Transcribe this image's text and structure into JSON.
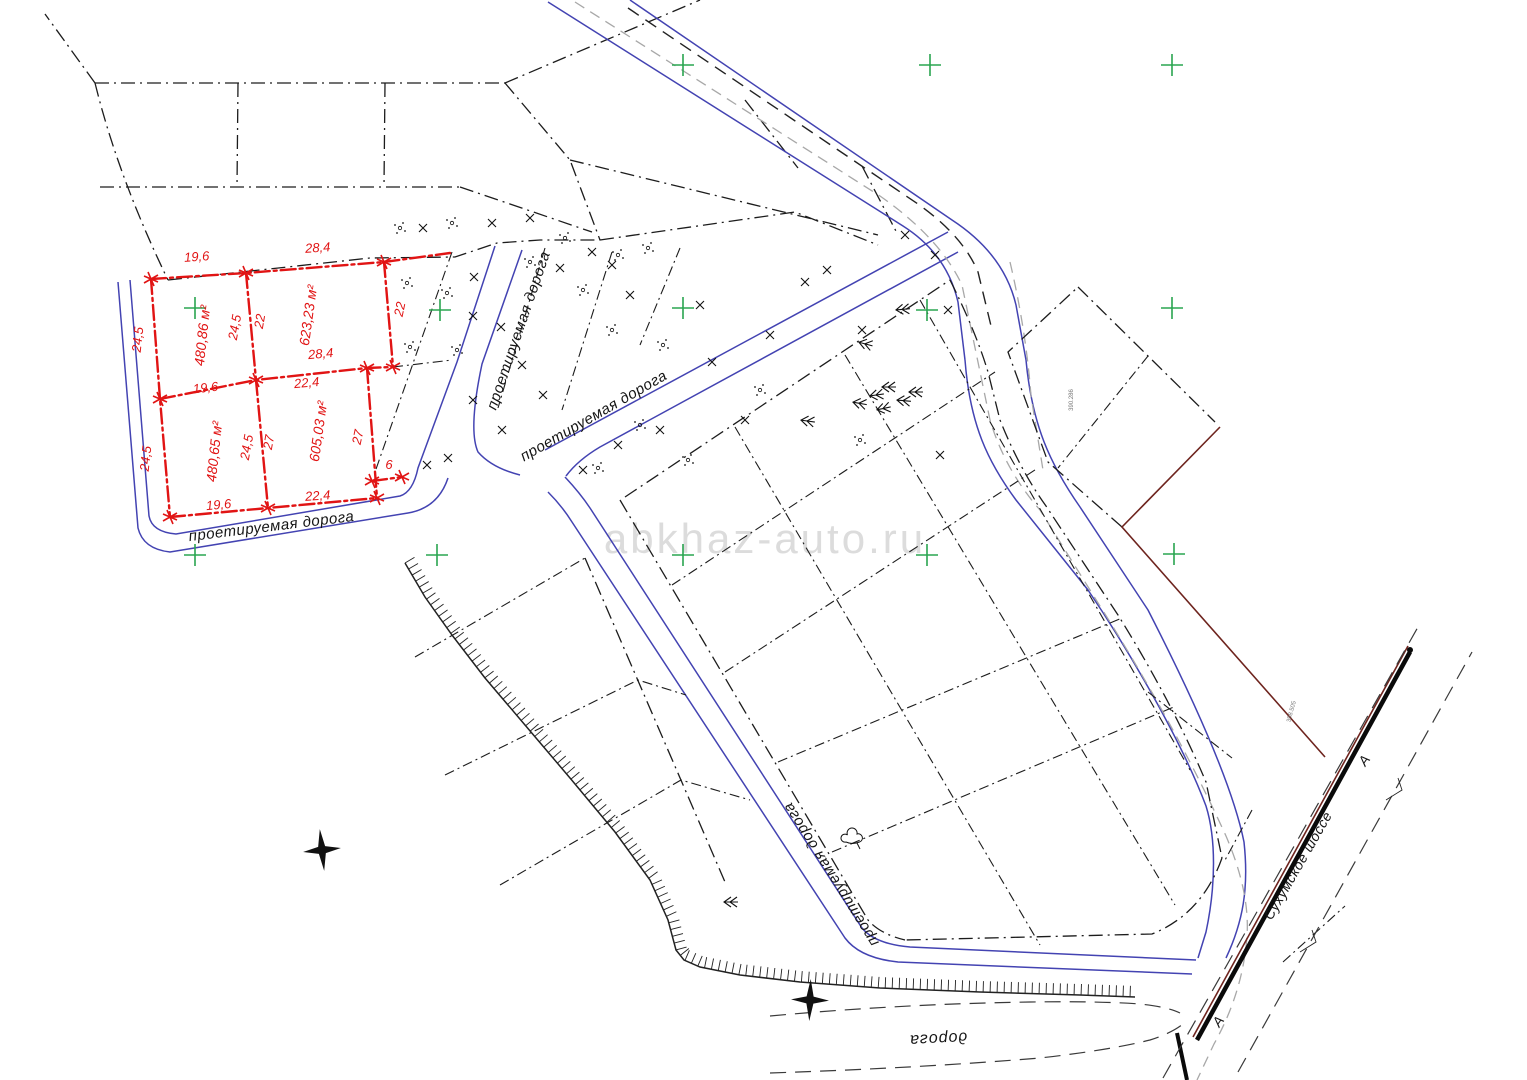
{
  "watermark": "abkhaz-auto.ru",
  "colors": {
    "plot_red": "#e11414",
    "road_blue": "#4343b2",
    "boundary_dark_red": "#6e241e",
    "grid_green": "#2aa550",
    "gray_dash": "#a8a8a8",
    "line_black": "#1c1c1c",
    "watermark_gray": "#dcdcdc"
  },
  "plots": [
    {
      "area_label": "480,86 м²",
      "sides": {
        "top": "19,6",
        "bottom": "19,6",
        "left": "24,5",
        "right": "24,5"
      }
    },
    {
      "area_label": "623,23 м²",
      "sides": {
        "top": "28,4",
        "bottom": "28,4",
        "left": "22",
        "right": "22"
      }
    },
    {
      "area_label": "480,65 м²",
      "sides": {
        "top": "19,6",
        "bottom": "19,6",
        "left": "24,5",
        "right": "24,5"
      }
    },
    {
      "area_label": "605,03 м²",
      "sides": {
        "top": "22,4",
        "bottom": "22,4",
        "left": "27",
        "right": "27"
      }
    }
  ],
  "extra_dimension": "6",
  "labels": {
    "items": [
      {
        "name": "dim-top-1",
        "text": "19,6",
        "x": 197,
        "y": 261,
        "rot": -4,
        "cls": "dim"
      },
      {
        "name": "dim-top-2",
        "text": "28,4",
        "x": 318,
        "y": 252,
        "rot": -4,
        "cls": "dim"
      },
      {
        "name": "dim-left-upper",
        "text": "24,5",
        "x": 142,
        "y": 340,
        "rot": -84,
        "cls": "dim"
      },
      {
        "name": "dim-mid-upper-w",
        "text": "24,5",
        "x": 239,
        "y": 328,
        "rot": -80,
        "cls": "dim"
      },
      {
        "name": "dim-mid-upper-e",
        "text": "22",
        "x": 264,
        "y": 322,
        "rot": -80,
        "cls": "dim"
      },
      {
        "name": "dim-right-upper",
        "text": "22",
        "x": 404,
        "y": 310,
        "rot": -78,
        "cls": "dim"
      },
      {
        "name": "dim-mid-1",
        "text": "19,6",
        "x": 206,
        "y": 392,
        "rot": -6,
        "cls": "dim"
      },
      {
        "name": "dim-mid-2",
        "text": "28,4",
        "x": 321,
        "y": 358,
        "rot": -5,
        "cls": "dim"
      },
      {
        "name": "dim-mid-3",
        "text": "22,4",
        "x": 307,
        "y": 387,
        "rot": -5,
        "cls": "dim"
      },
      {
        "name": "dim-left-lower",
        "text": "24,5",
        "x": 150,
        "y": 459,
        "rot": -84,
        "cls": "dim"
      },
      {
        "name": "dim-mid-lower-w",
        "text": "24,5",
        "x": 251,
        "y": 448,
        "rot": -80,
        "cls": "dim"
      },
      {
        "name": "dim-mid-lower-e",
        "text": "27",
        "x": 273,
        "y": 443,
        "rot": -80,
        "cls": "dim"
      },
      {
        "name": "dim-right-lower",
        "text": "27",
        "x": 362,
        "y": 438,
        "rot": -78,
        "cls": "dim"
      },
      {
        "name": "dim-ext",
        "text": "6",
        "x": 389,
        "y": 469,
        "rot": 0,
        "cls": "dim"
      },
      {
        "name": "dim-bot-1",
        "text": "19,6",
        "x": 219,
        "y": 509,
        "rot": -5,
        "cls": "dim"
      },
      {
        "name": "dim-bot-2",
        "text": "22,4",
        "x": 318,
        "y": 500,
        "rot": -4,
        "cls": "dim"
      },
      {
        "name": "area-plot-1",
        "text": "480,86 м²",
        "x": 207,
        "y": 336,
        "rot": -84,
        "cls": "area"
      },
      {
        "name": "area-plot-2",
        "text": "623,23 м²",
        "x": 313,
        "y": 316,
        "rot": -82,
        "cls": "area"
      },
      {
        "name": "area-plot-3",
        "text": "480,65 м²",
        "x": 219,
        "y": 452,
        "rot": -84,
        "cls": "area"
      },
      {
        "name": "area-plot-4",
        "text": "605,03 м²",
        "x": 323,
        "y": 432,
        "rot": -82,
        "cls": "area"
      },
      {
        "name": "road-label-southwest",
        "text": "проетируемая дорога",
        "x": 272,
        "y": 531,
        "rot": -7,
        "cls": "road-lbl"
      },
      {
        "name": "road-label-north",
        "text": "проетируемая дорога",
        "x": 523,
        "y": 332,
        "rot": -71,
        "cls": "road-lbl"
      },
      {
        "name": "road-label-diagonal",
        "text": "проетируемая дорога",
        "x": 596,
        "y": 420,
        "rot": -30,
        "cls": "road-lbl"
      },
      {
        "name": "road-label-central",
        "text": "проетируемая дорога",
        "x": 835,
        "y": 872,
        "rot": -122,
        "cls": "road-lbl"
      },
      {
        "name": "road-label-bottom",
        "text": "дорога",
        "x": 938,
        "y": 1034,
        "rot": 177,
        "cls": "road-lbl2"
      },
      {
        "name": "highway-label",
        "text": "Сухумское шоссе",
        "x": 1302,
        "y": 868,
        "rot": -60,
        "cls": "hw"
      },
      {
        "name": "axis-letter-1",
        "text": "А",
        "x": 1222,
        "y": 1024,
        "rot": -55,
        "cls": "a"
      },
      {
        "name": "axis-letter-2",
        "text": "А",
        "x": 1368,
        "y": 763,
        "rot": -55,
        "cls": "a"
      },
      {
        "name": "coord-note-1",
        "text": "390.286",
        "x": 1073,
        "y": 400,
        "rot": -90,
        "cls": "tiny"
      },
      {
        "name": "coord-note-2",
        "text": "398.505",
        "x": 1293,
        "y": 712,
        "rot": -75,
        "cls": "tiny"
      }
    ]
  },
  "symbols": {
    "green_crosses": [
      [
        683,
        65
      ],
      [
        930,
        65
      ],
      [
        1172,
        65
      ],
      [
        195,
        308
      ],
      [
        440,
        310
      ],
      [
        683,
        308
      ],
      [
        927,
        310
      ],
      [
        1172,
        308
      ],
      [
        195,
        555
      ],
      [
        437,
        555
      ],
      [
        683,
        555
      ],
      [
        927,
        555
      ],
      [
        1174,
        554
      ]
    ],
    "survey_stars": [
      [
        322,
        850,
        -6
      ],
      [
        810,
        1000,
        2
      ]
    ],
    "conifer_trees": [
      [
        895,
        310,
        -5
      ],
      [
        852,
        402,
        10
      ],
      [
        869,
        396,
        -8
      ],
      [
        881,
        387,
        0
      ],
      [
        896,
        400,
        5
      ],
      [
        876,
        410,
        -12
      ],
      [
        908,
        392,
        0
      ],
      [
        800,
        420,
        8
      ],
      [
        723,
        902,
        0
      ],
      [
        858,
        342,
        15
      ]
    ],
    "cloud_trees": [
      [
        852,
        840,
        0
      ]
    ],
    "x_marks": [
      [
        423,
        228
      ],
      [
        492,
        223
      ],
      [
        530,
        218
      ],
      [
        474,
        277
      ],
      [
        473,
        316
      ],
      [
        501,
        327
      ],
      [
        522,
        365
      ],
      [
        543,
        395
      ],
      [
        473,
        400
      ],
      [
        502,
        430
      ],
      [
        560,
        268
      ],
      [
        592,
        252
      ],
      [
        612,
        265
      ],
      [
        630,
        295
      ],
      [
        660,
        430
      ],
      [
        700,
        305
      ],
      [
        712,
        362
      ],
      [
        745,
        420
      ],
      [
        770,
        335
      ],
      [
        805,
        282
      ],
      [
        827,
        270
      ],
      [
        862,
        330
      ],
      [
        905,
        235
      ],
      [
        935,
        255
      ],
      [
        948,
        310
      ],
      [
        427,
        465
      ],
      [
        448,
        458
      ],
      [
        583,
        470
      ],
      [
        618,
        445
      ],
      [
        940,
        455
      ]
    ],
    "dot_clusters": [
      [
        400,
        228
      ],
      [
        452,
        223
      ],
      [
        407,
        283
      ],
      [
        447,
        293
      ],
      [
        410,
        347
      ],
      [
        457,
        350
      ],
      [
        530,
        262
      ],
      [
        565,
        238
      ],
      [
        583,
        290
      ],
      [
        612,
        330
      ],
      [
        640,
        425
      ],
      [
        598,
        468
      ],
      [
        663,
        345
      ],
      [
        688,
        460
      ],
      [
        760,
        390
      ],
      [
        860,
        440
      ],
      [
        618,
        255
      ],
      [
        648,
        248
      ]
    ],
    "red_corner_marks": [
      [
        151,
        279
      ],
      [
        246,
        273
      ],
      [
        384,
        262
      ],
      [
        160,
        399
      ],
      [
        256,
        380
      ],
      [
        367,
        368
      ],
      [
        393,
        367
      ],
      [
        170,
        517
      ],
      [
        268,
        508
      ],
      [
        377,
        498
      ],
      [
        372,
        481
      ],
      [
        402,
        477
      ]
    ]
  }
}
